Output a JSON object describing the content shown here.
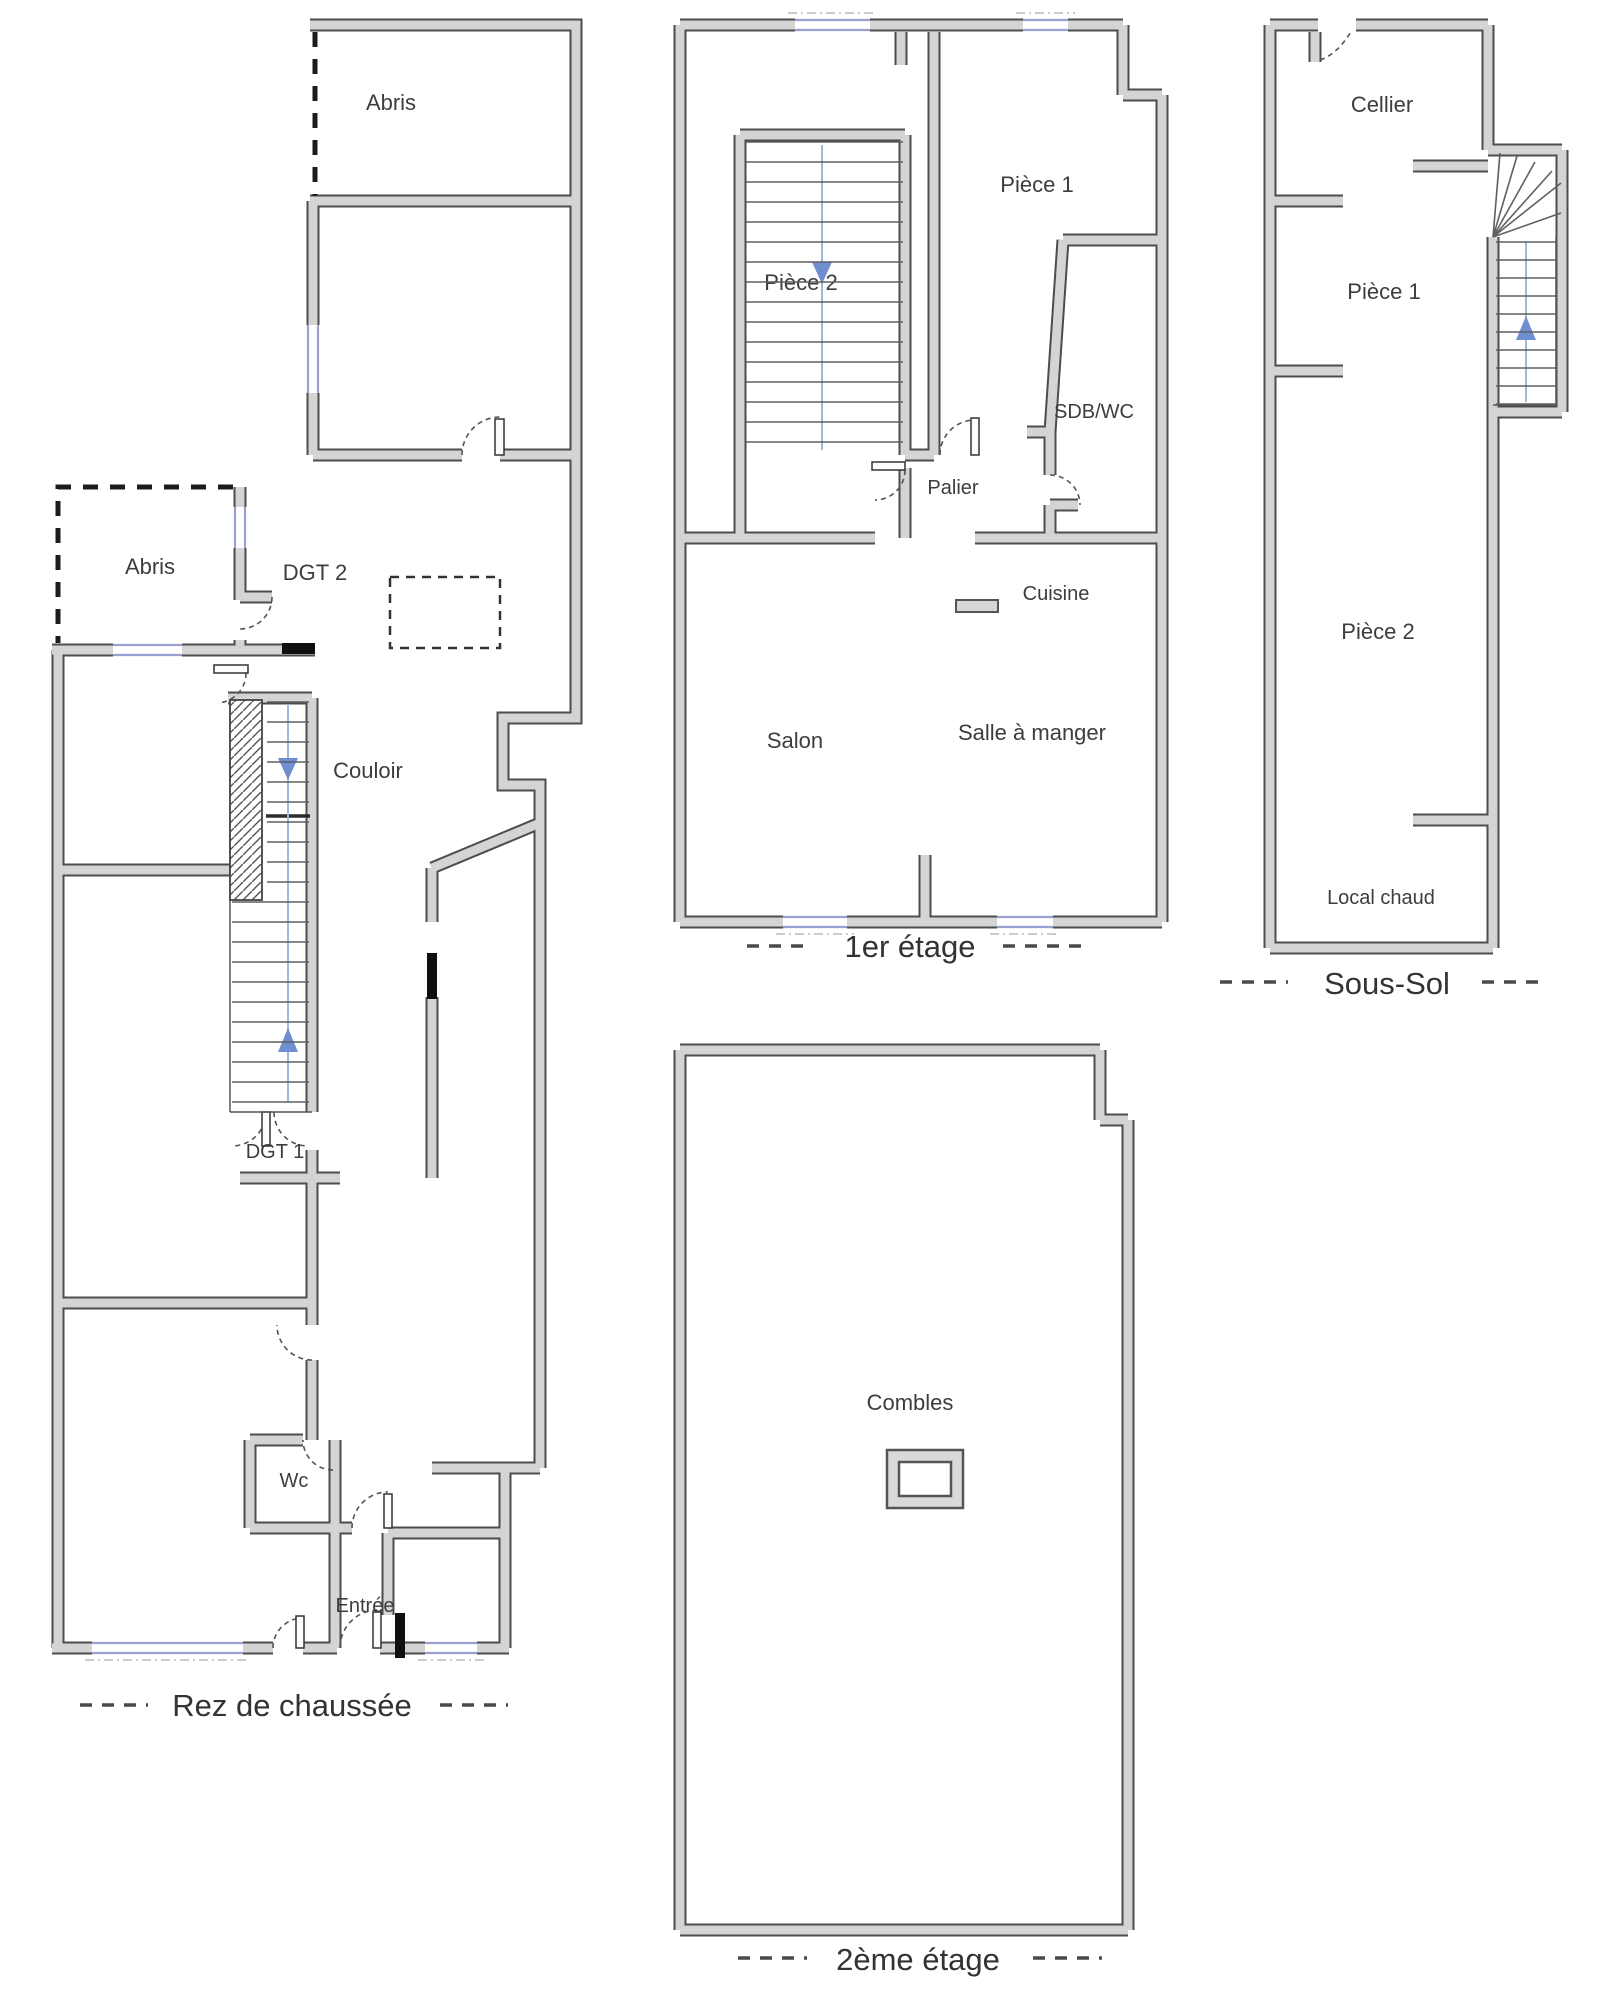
{
  "document_type": "floor-plan-drawing",
  "colors": {
    "background": "#ffffff",
    "wall_fill": "#d4d4d4",
    "wall_outline": "#4d4d4d",
    "window": "#98a0d4",
    "stair_guide": "#9db8dd",
    "arrow_blue": "#6f8fd0",
    "text": "#3d3d3d"
  },
  "plans": {
    "rez": {
      "title": "Rez de chaussée",
      "rooms": {
        "abris_top": "Abris",
        "abris_lower": "Abris",
        "dgt2": "DGT 2",
        "couloir": "Couloir",
        "dgt1": "DGT 1",
        "wc": "Wc",
        "entree": "Entrée"
      }
    },
    "etage1": {
      "title": "1er étage",
      "rooms": {
        "piece2": "Pièce 2",
        "piece1": "Pièce 1",
        "sdb": "SDB/WC",
        "palier": "Palier",
        "cuisine": "Cuisine",
        "salon": "Salon",
        "salle_a_manger": "Salle à manger"
      }
    },
    "sous_sol": {
      "title": "Sous-Sol",
      "rooms": {
        "cellier": "Cellier",
        "piece1": "Pièce 1",
        "piece2": "Pièce 2",
        "local_chaud": "Local chaud"
      }
    },
    "etage2": {
      "title": "2ème étage",
      "rooms": {
        "combles": "Combles"
      }
    }
  }
}
